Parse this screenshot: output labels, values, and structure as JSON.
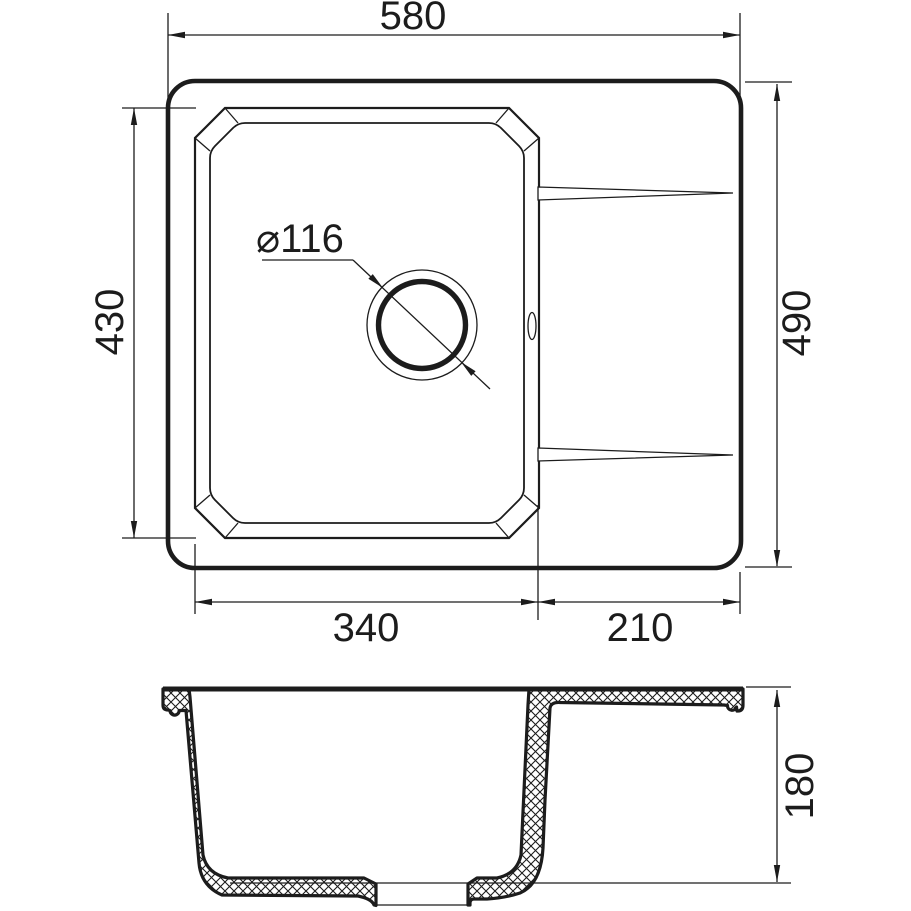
{
  "drawing": {
    "background": "#ffffff",
    "line_color": "#1c1c1c",
    "dimensions": {
      "overall_width": "580",
      "overall_depth": "490",
      "bowl_length": "430",
      "bowl_width": "340",
      "drainboard_width": "210",
      "drain_diameter": "⌀116",
      "bowl_depth": "180"
    }
  }
}
